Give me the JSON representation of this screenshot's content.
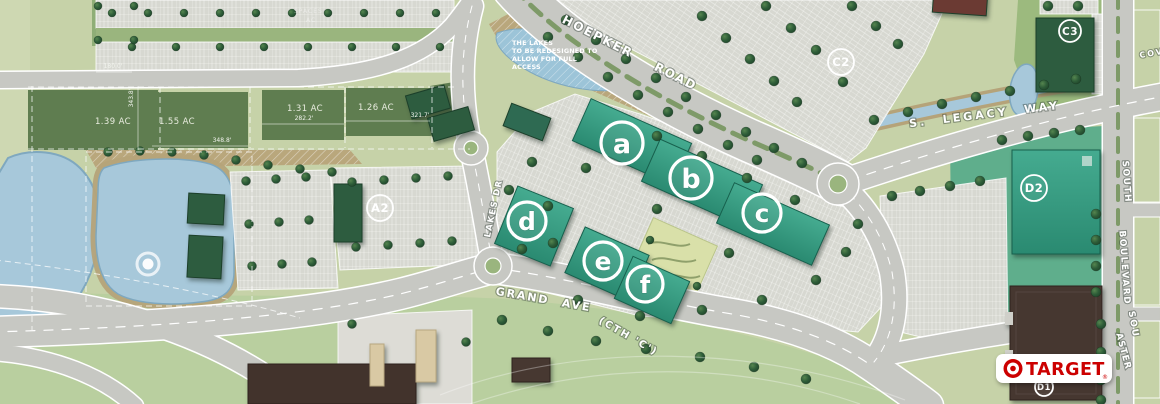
{
  "title": "Retail development site plan",
  "streets": {
    "hoepker_word1": "HOEPKER",
    "hoepker_word2": "ROAD",
    "legacy": "S. LEGACY WAY",
    "grand": "GRAND AVE",
    "grand_cth": "(CTH 'C')",
    "lakes_dr": "LAKES DR",
    "south": "SOUTH",
    "boulevard": "BOULEVARD",
    "south_partial": "SOU",
    "aster": "ASTER",
    "cove_partial": "COV"
  },
  "building_markers": {
    "a": "a",
    "b": "b",
    "c": "c",
    "d": "d",
    "e": "e",
    "f": "f"
  },
  "lot_markers": {
    "a2": "A2",
    "c2": "C2",
    "c3": "C3",
    "d2": "D2",
    "d1": "D1"
  },
  "parcels": {
    "p1": "1.39 AC",
    "p2": "1.55 AC",
    "p3": "1.31 AC",
    "p4": "1.26 AC"
  },
  "dimensions": {
    "dim1": "180.0'",
    "dim2": "343.8'",
    "dim3": "348.8'",
    "dim4": "282.2'",
    "dim5": "321.7'"
  },
  "lake_note": {
    "line1": "THE LAKES",
    "line2": "TO BE REDESIGNED TO",
    "line3": "ALLOW FOR FULL",
    "line4": "ACCESS"
  },
  "faint_note": {
    "line1": "SPACES",
    "line2": "AC"
  },
  "brand": {
    "target_name": "TARGET",
    "target_mark": "®"
  },
  "colors": {
    "building_teal": "#35a089",
    "building_darkgreen": "#2d5c3f",
    "building_brown": "#463730",
    "water": "#a7c8da",
    "road": "#c7c8c3",
    "parking": "#d7d8d1",
    "grass": "#c6d2a8",
    "lawn_bright": "#5fae8c",
    "berm_tan": "#b5a379",
    "target_red": "#cc0000",
    "marker_ring": "#ffffff"
  }
}
